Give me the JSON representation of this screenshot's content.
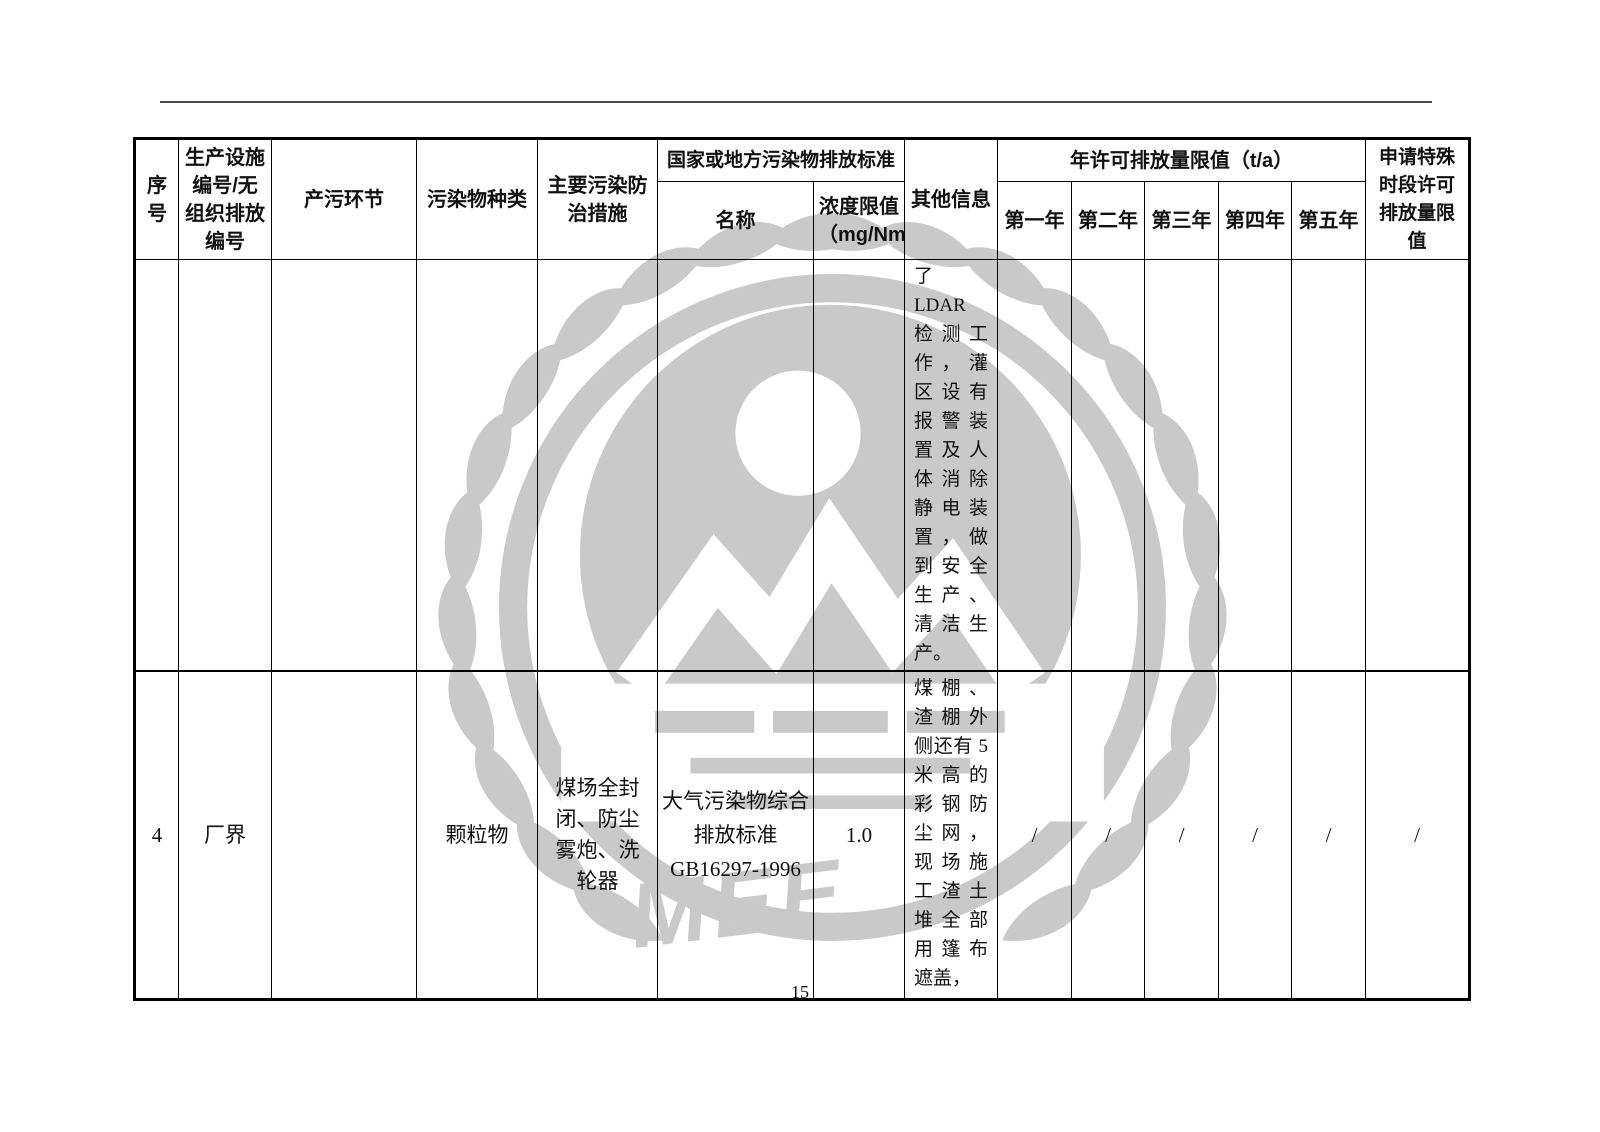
{
  "colors": {
    "watermark": "#c9c9c9",
    "border": "#000000",
    "rule": "#4a4a4a",
    "text": "#111111"
  },
  "page": {
    "number": "15"
  },
  "watermark": {
    "label": "MEE"
  },
  "table": {
    "headers": {
      "index": "序号",
      "facility": "生产设施编号/无组织排放编号",
      "process": "产污环节",
      "pollutant": "污染物种类",
      "measures": "主要污染防治措施",
      "standard_group": "国家或地方污染物排放标准",
      "standard_name": "名称",
      "limit": "浓度限值（mg/Nm³）",
      "other": "其他信息",
      "annual_group": "年许可排放量限值（t/a）",
      "year1": "第一年",
      "year2": "第二年",
      "year3": "第三年",
      "year4": "第四年",
      "year5": "第五年",
      "special": "申请特殊时段许可排放量限值"
    },
    "rows": [
      {
        "cells": [
          "",
          "",
          "",
          "",
          "",
          "",
          "",
          "了 LDAR 检测工作，灌区设有报警装置及人体消除静电装置，做到安全生产、清洁生产。",
          "",
          "",
          "",
          "",
          "",
          ""
        ]
      },
      {
        "cells": [
          "4",
          "厂界",
          "",
          "颗粒物",
          "煤场全封闭、防尘雾炮、洗轮器",
          "大气污染物综合\n排放标准\nGB16297-1996",
          "1.0",
          "煤棚、渣棚外侧还有 5 米高的彩钢防尘网，现场施工渣土堆全部用篷布遮盖，",
          "/",
          "/",
          "/",
          "/",
          "/",
          "/"
        ]
      }
    ]
  }
}
